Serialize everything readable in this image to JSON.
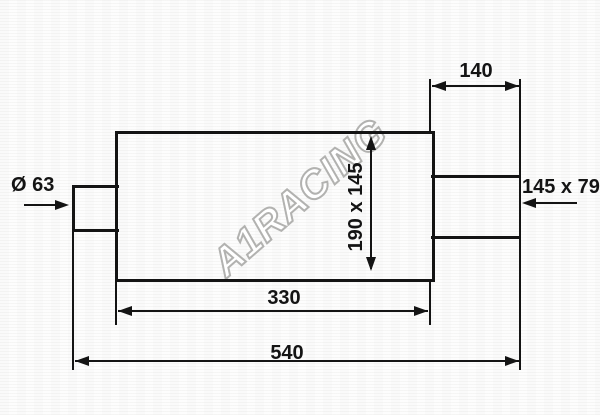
{
  "drawing": {
    "kind": "muffler-technical-drawing",
    "watermark": {
      "text": "A1RACING",
      "color": "#b2b2b0"
    },
    "labels": {
      "inlet_diameter": "Ø 63",
      "tail_length": "140",
      "outlet_size": "145 x 79",
      "body_section": "190 x 145",
      "body_length": "330",
      "total_length": "540"
    },
    "colors": {
      "line": "#141414",
      "background": "#fdfdfd",
      "watermark_outline": "#b2b2b0",
      "watermark_fill": "#ffffff"
    }
  }
}
